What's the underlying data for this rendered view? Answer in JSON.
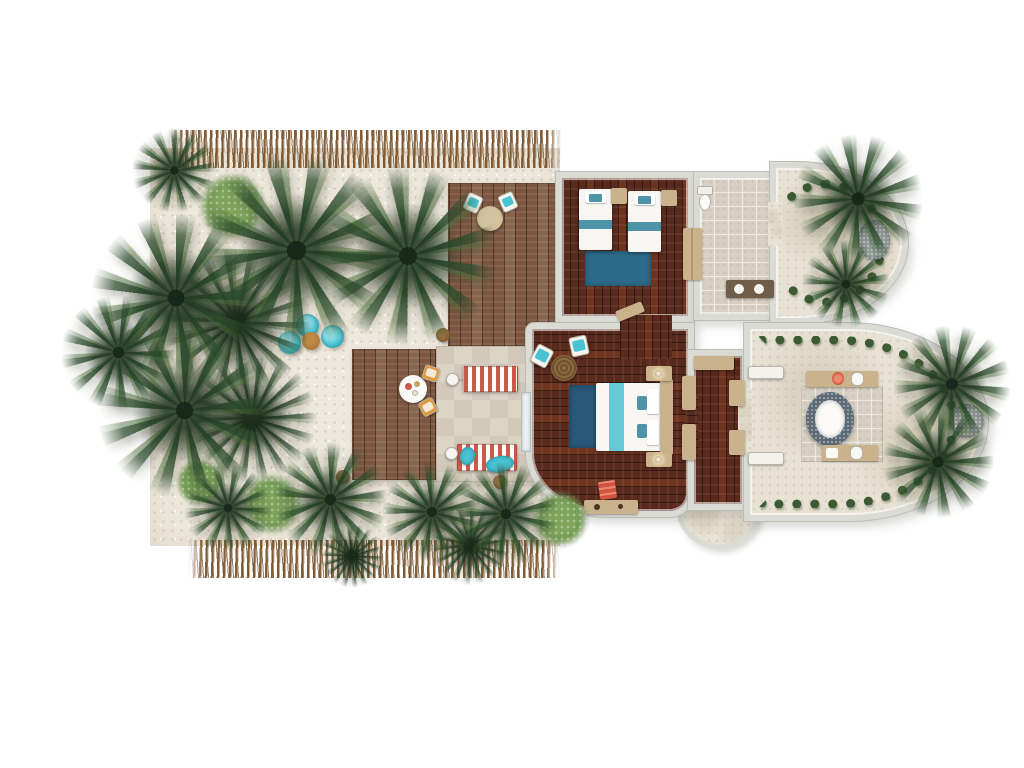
{
  "meta": {
    "title": "Tropical beach villa floor plan — top-down 3D render",
    "visible_text": "none"
  },
  "theme": {
    "colors": {
      "sand": "#efe9dd",
      "deckWood": "#7c5640",
      "floorWood": "#58291c",
      "wall": "#dbdbd6",
      "wallEdge": "#bdbdb7",
      "tile": "#d8d0c2",
      "stone": "#e8e2d4",
      "patioA": "#dcd4c5",
      "patioB": "#d2c9ba",
      "bedWhite": "#f7f6f2",
      "headboardTan": "#c9b28c",
      "teal": "#49c2d1",
      "tealBand": "#4f93a8",
      "rugBlueTwin": "#2d6b8a",
      "rugBlueMain": "#2a587a",
      "stripeRed": "#cd584c",
      "orange": "#dd9a40",
      "coral": "#d2543f",
      "pebble": "#9aa3a3",
      "tubMosaic": "#5c6a76",
      "hedge": "#3c5a33",
      "bushLight": "#7fa55c",
      "poufBrown": "#a06c2c"
    }
  },
  "scene": {
    "rooms": [
      {
        "id": "twin-bedroom",
        "name": "Twin bedroom with two single beds and blue rug"
      },
      {
        "id": "twin-bathroom",
        "name": "En-suite bathroom with toilet and vanity"
      },
      {
        "id": "outdoor-shower-garden",
        "name": "Curved outdoor shower garden with pebble mat"
      },
      {
        "id": "master-bedroom",
        "name": "Master bedroom with king bed, chairs and desk"
      },
      {
        "id": "dressing-corridor",
        "name": "Dressing corridor with wardrobes"
      },
      {
        "id": "master-bathroom",
        "name": "Curved open-air bathroom with oval tub and two vanities"
      },
      {
        "id": "entry-step",
        "name": "Semi-circular entry step"
      }
    ],
    "outdoor_features": [
      {
        "id": "upper-deck",
        "name": "Timber deck with round table and two teal chairs"
      },
      {
        "id": "lower-deck",
        "name": "Timber dining deck with round table and two orange chairs"
      },
      {
        "id": "patio",
        "name": "Stone patio with two red-striped sun loungers and side tables"
      },
      {
        "id": "bean-bag-lounge",
        "name": "Three turquoise bean bags around a rattan pouf"
      },
      {
        "id": "thatch-fence-top",
        "name": "Palm-thatch boundary fence (top)"
      },
      {
        "id": "thatch-fence-bottom",
        "name": "Palm-thatch boundary fence (bottom)"
      }
    ],
    "furniture_counts": {
      "twin_beds": 2,
      "king_beds": 1,
      "sun_loungers": 2,
      "bean_bags": 3,
      "deck_chairs": 2,
      "dining_chairs": 2,
      "bedroom_chairs": 2,
      "bathtubs": 1,
      "toilets": 1,
      "vanities": 3,
      "wardrobes": 5,
      "pebble_mats": 2
    },
    "vegetation": {
      "palms": [
        [
          296,
          250,
          195,
          8
        ],
        [
          408,
          256,
          180,
          42
        ],
        [
          176,
          298,
          170,
          0
        ],
        [
          184,
          410,
          175,
          24
        ],
        [
          118,
          352,
          115,
          60
        ],
        [
          174,
          170,
          85,
          78
        ],
        [
          858,
          199,
          130,
          12
        ],
        [
          846,
          284,
          88,
          48
        ],
        [
          952,
          384,
          118,
          66
        ],
        [
          938,
          462,
          112,
          28
        ],
        [
          330,
          499,
          115,
          52
        ],
        [
          432,
          512,
          100,
          18
        ],
        [
          506,
          514,
          104,
          72
        ],
        [
          228,
          508,
          88,
          34
        ]
      ],
      "ferns": [
        [
          236,
          322,
          150,
          10
        ],
        [
          252,
          418,
          130,
          65
        ],
        [
          470,
          545,
          80,
          20
        ],
        [
          352,
          556,
          64,
          50
        ]
      ],
      "bushes": [
        [
          232,
          206,
          72
        ],
        [
          272,
          504,
          66
        ],
        [
          560,
          519,
          62
        ],
        [
          200,
          482,
          52
        ]
      ]
    },
    "props": {
      "bean_bags": [
        [
          289,
          342
        ],
        [
          307,
          325
        ],
        [
          332,
          336
        ]
      ],
      "pouf": [
        311,
        341
      ],
      "coconuts": [
        [
          443,
          335
        ],
        [
          343,
          477
        ],
        [
          500,
          482
        ]
      ]
    }
  }
}
